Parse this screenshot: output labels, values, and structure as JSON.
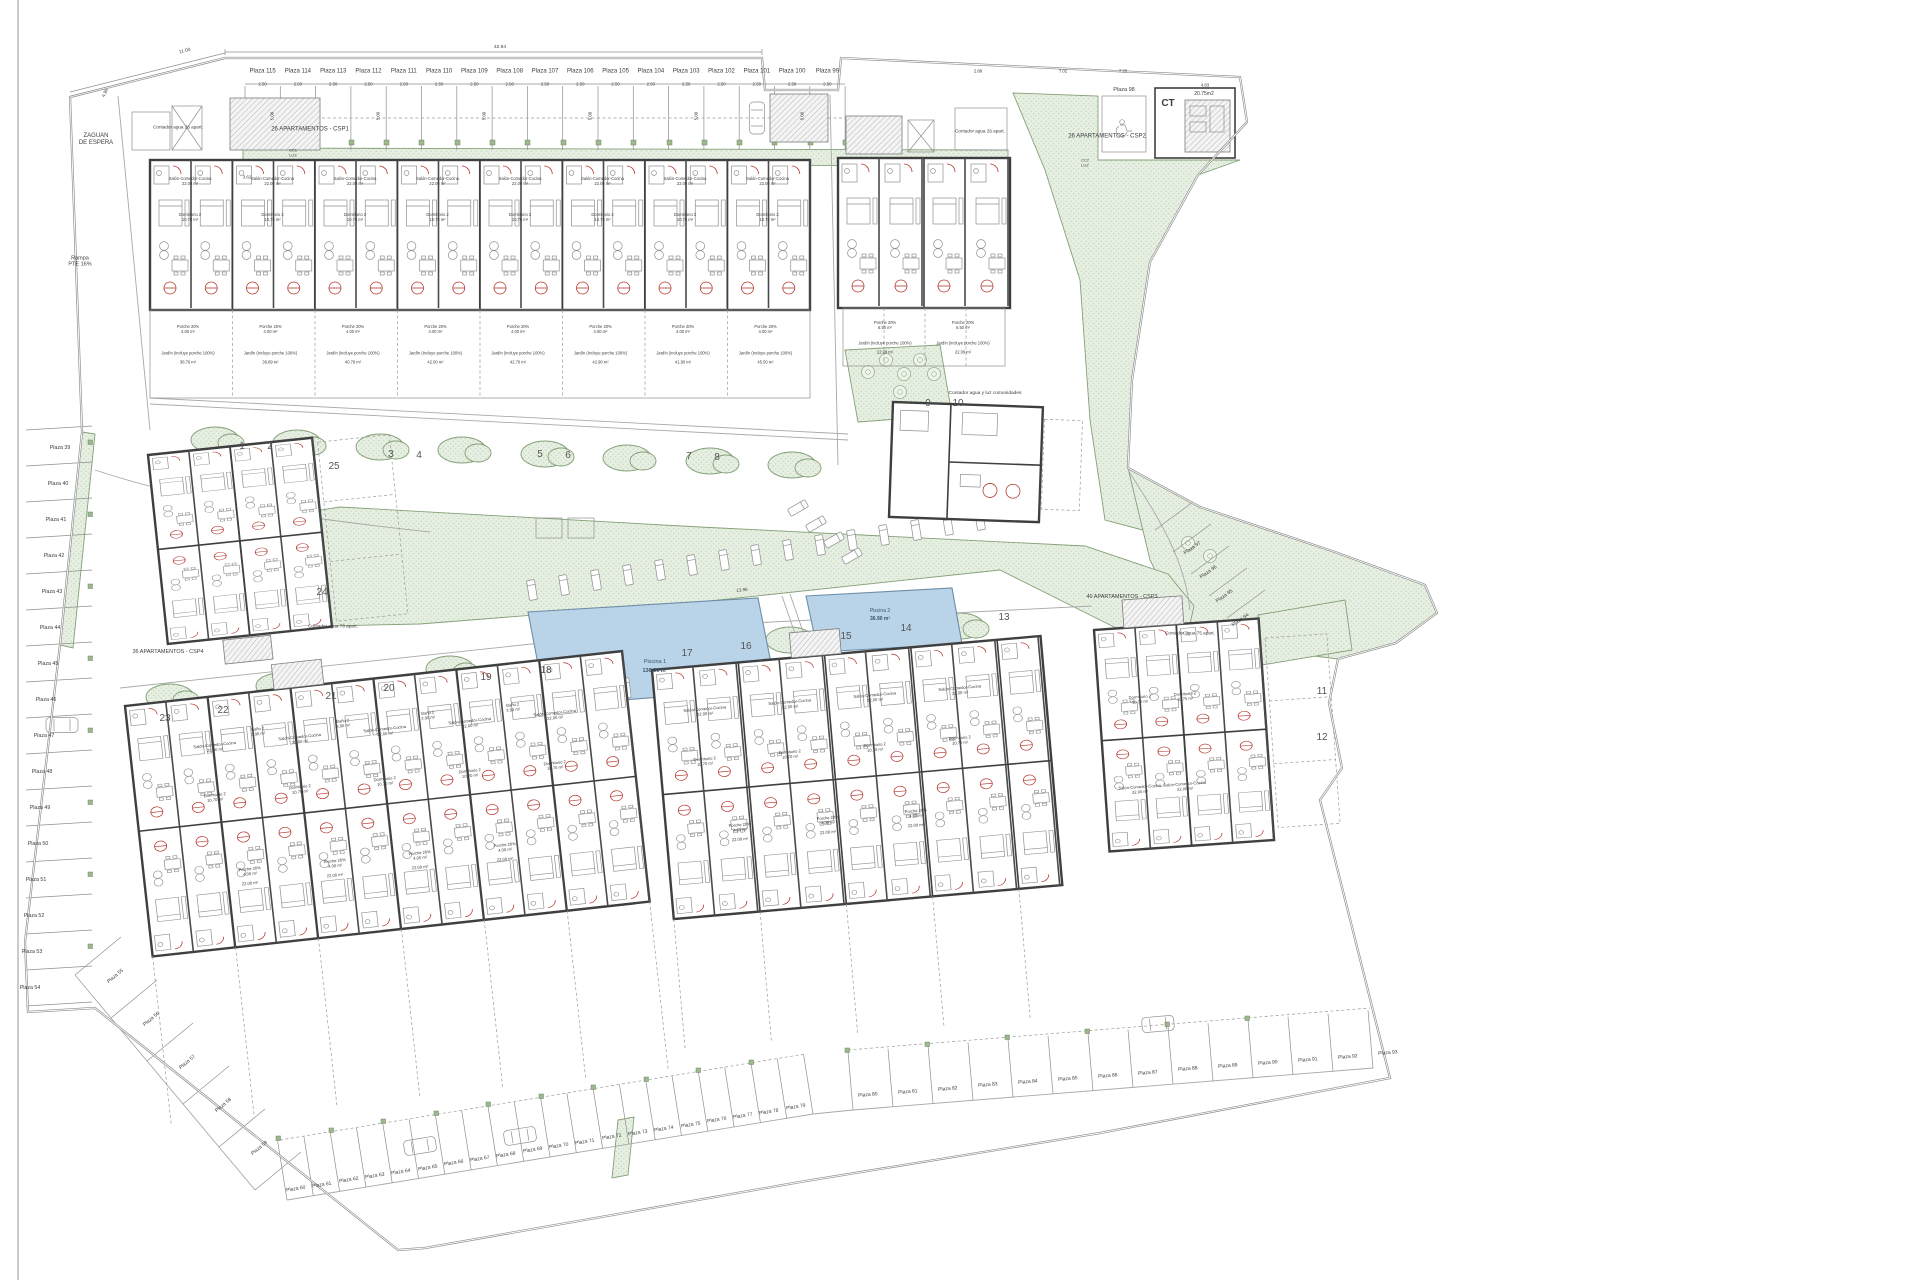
{
  "title": "Plano de conjunto - urbanización de apartamentos",
  "site": {
    "entry": "ZAGUAN\nDE ESPERA",
    "ramp": "Rampa\nPTE 16%",
    "communal_meter": "Contador agua y luz comunidades",
    "transformer": {
      "label": "CT",
      "area": "20.75m2"
    },
    "elec1": "CC1\nLUZ",
    "elec2": "CC2\nLUZ"
  },
  "blocks": {
    "csp1": {
      "label": "26 APARTAMENTOS - CSP1",
      "meter": "Contador agua 26 apart."
    },
    "csp2": {
      "label": "26 APARTAMENTOS - CSP2",
      "meter": "Contador agua 26 apart."
    },
    "csp3": {
      "label": "40 APARTAMENTOS - CSP3",
      "meter": "Contador agua 75 apart."
    },
    "csp4": {
      "label": "36 APARTAMENTOS - CSP4",
      "meter": "Contador agua 76 apart."
    }
  },
  "pools": [
    {
      "name": "Piscina 1",
      "area": "136.30 m²"
    },
    {
      "name": "Piscina 2",
      "area": "36.90 m²"
    }
  ],
  "parking": {
    "top_row": [
      "Plaza 115",
      "Plaza 114",
      "Plaza 113",
      "Plaza 112",
      "Plaza 111",
      "Plaza 110",
      "Plaza 109",
      "Plaza 108",
      "Plaza 107",
      "Plaza 106",
      "Plaza 105",
      "Plaza 104",
      "Plaza 103",
      "Plaza 102",
      "Plaza 101",
      "Plaza 100",
      "Plaza 99"
    ],
    "accessible": "Plaza 98",
    "left_column": [
      "Plaza 39",
      "Plaza 40",
      "Plaza 41",
      "Plaza 42",
      "Plaza 43",
      "Plaza 44",
      "Plaza 45",
      "Plaza 46",
      "Plaza 47",
      "Plaza 48",
      "Plaza 49",
      "Plaza 50",
      "Plaza 51",
      "Plaza 52",
      "Plaza 53",
      "Plaza 54"
    ],
    "bottom_row_a": [
      "Plaza 55",
      "Plaza 56",
      "Plaza 57",
      "Plaza 58",
      "Plaza 59"
    ],
    "bottom_row_b": [
      "Plaza 60",
      "Plaza 61",
      "Plaza 62",
      "Plaza 63",
      "Plaza 64",
      "Plaza 65",
      "Plaza 66",
      "Plaza 67",
      "Plaza 68",
      "Plaza 69",
      "Plaza 70",
      "Plaza 71",
      "Plaza 72",
      "Plaza 73",
      "Plaza 74",
      "Plaza 75",
      "Plaza 76",
      "Plaza 77",
      "Plaza 78",
      "Plaza 79"
    ],
    "bottom_row_c": [
      "Plaza 80",
      "Plaza 81",
      "Plaza 82",
      "Plaza 83",
      "Plaza 84",
      "Plaza 85",
      "Plaza 86",
      "Plaza 87",
      "Plaza 88",
      "Plaza 89",
      "Plaza 90",
      "Plaza 91",
      "Plaza 92",
      "Plaza 93"
    ],
    "right_curve": [
      "Plaza 97",
      "Plaza 96",
      "Plaza 95",
      "Plaza 94"
    ]
  },
  "unit_numbers": [
    "1",
    "2",
    "3",
    "4",
    "5",
    "6",
    "7",
    "8",
    "9",
    "10",
    "11",
    "12",
    "13",
    "14",
    "15",
    "16",
    "17",
    "18",
    "19",
    "20",
    "21",
    "22",
    "23",
    "24",
    "25"
  ],
  "rooms": {
    "salon": "Salón-Comedor-Cocina\n22.00 m²",
    "dormitorio2": "Dormitorio 2\n10.70 m²",
    "bano2": "Baño 2\n3.90 m²",
    "porche": "Porche 20%\n4.00 m²",
    "porche_b": "Porche 20%\n6.50 m²"
  },
  "gardens": {
    "jardin": "Jardín (incluye porche 100%)",
    "areas": [
      "38.76 m²",
      "39.89 m²",
      "40.78 m²",
      "42.00 m²",
      "42.76 m²",
      "42.90 m²",
      "41.90 m²",
      "45.50 m²"
    ],
    "area_b": "22.09 m²",
    "area_bottom": "22.00 m²"
  },
  "dims": {
    "slot_width": "2.50",
    "slot_depth": "5.00",
    "top_left_width": "11.00",
    "top_span": "42.94",
    "edge_top_left": "4.98",
    "stair_width": "3.62",
    "top_right": [
      "2.88",
      "7.02",
      "7.20",
      "4.83"
    ],
    "pool_deck": "13.96"
  }
}
